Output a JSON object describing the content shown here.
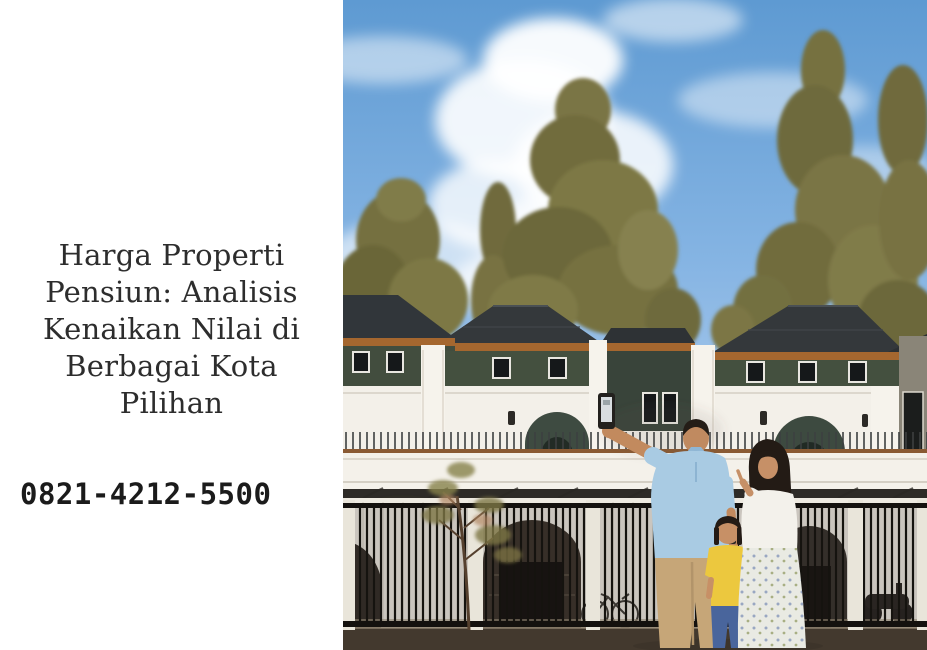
{
  "meta": {
    "width": 927,
    "height": 650
  },
  "content": {
    "title_lines": [
      "Harga Properti",
      "Pensiun: Analisis",
      "Kenaikan Nilai di",
      "Berbagai Kota",
      "Pilihan"
    ],
    "title_full": "Harga Properti Pensiun: Analisis Kenaikan Nilai di Berbagai Kota Pilihan",
    "phone_number": "0821-4212-5500"
  },
  "hero": {
    "name": "family-showcasing-new-townhouse",
    "description": "Family of three in front of a row of modern white two-storey townhouses with dark hip roofs: father in light blue polo raising a smartphone, mother in white blouse pointing upward, child in yellow shirt and jeans; olive-green trees and blue sky with clouds behind, black metal fence in front."
  },
  "palette": {
    "background": "#ffffff",
    "title_text": "#2d2d2d",
    "phone_text": "#1b1b1b",
    "sky_top": "#5e9ad2",
    "sky_bottom": "#cfe2f4",
    "foliage": "#787243",
    "roof": "#34383b",
    "roof_trim": "#a5672f",
    "upper_wall": "#424d3e",
    "facade": "#f3f0e9",
    "fence": "#14110e",
    "father_polo": "#a9cbe3",
    "father_pants": "#c6a678",
    "child_shirt": "#ecc83e",
    "child_jeans": "#49659c",
    "mother_top": "#f3f1eb",
    "skin": "#c28a5e"
  }
}
